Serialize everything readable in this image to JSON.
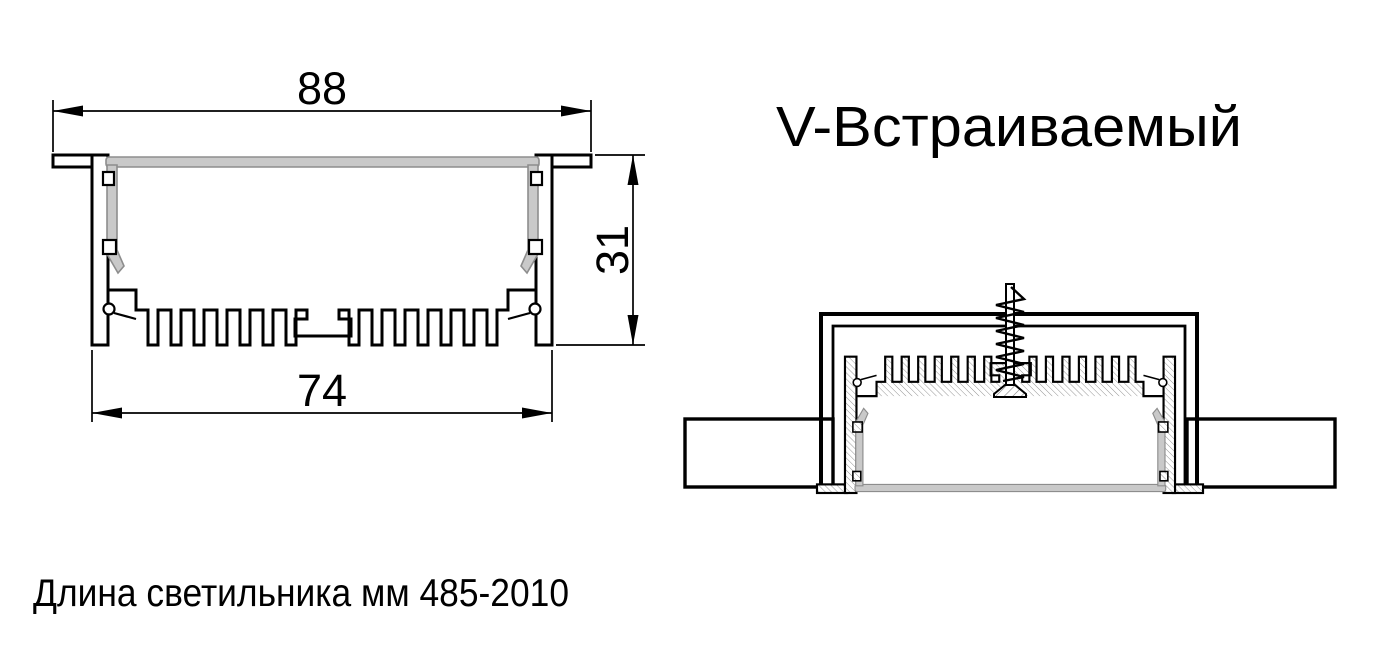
{
  "title": "V-Встраиваемый",
  "footer_note": "Длина светильника мм 485-2010",
  "dimensions": {
    "overall_width_mm": "88",
    "body_width_mm": "74",
    "height_mm": "31"
  },
  "colors": {
    "line": "#000000",
    "diffuser_fill": "#c9c9c9",
    "diffuser_stroke": "#8d8d8d",
    "background": "#ffffff"
  }
}
